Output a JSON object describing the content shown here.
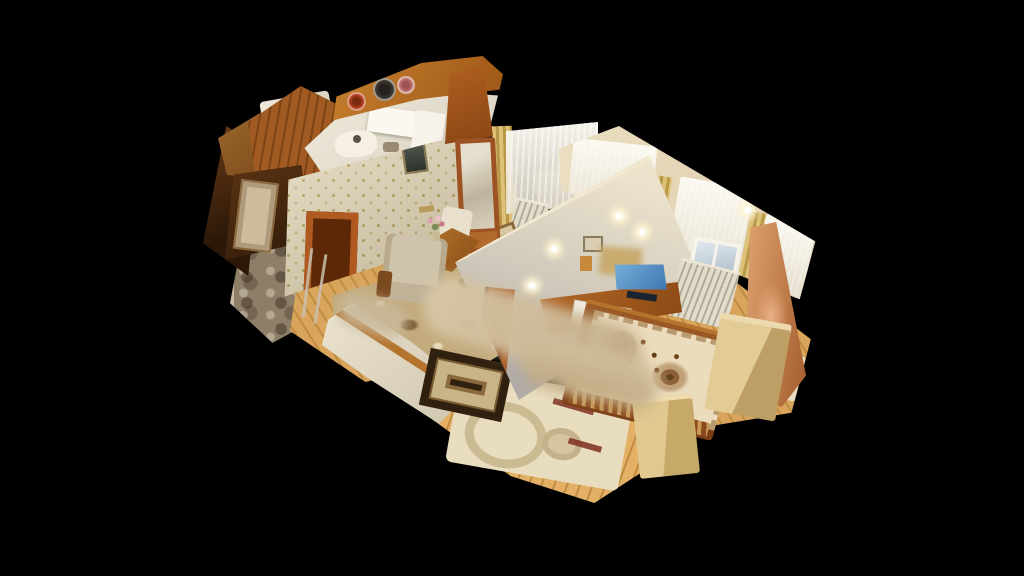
{
  "meta": {
    "type": "3d-dollhouse-scan-view",
    "description": "Cutaway dollhouse view of a furnished apartment 3D scan floating on a black background; no UI chrome, no text",
    "width": 1024,
    "height": 576
  },
  "viewport": {
    "background": "#000000",
    "interaction": "drag-to-orbit-model"
  },
  "rooms": [
    {
      "name": "kitchen",
      "position": "top",
      "features": [
        "white-counters",
        "fridge",
        "wood-upper-wall",
        "three-decorative-wall-plates"
      ]
    },
    {
      "name": "bathroom",
      "position": "top-left",
      "features": [
        "wood-panel-walls",
        "picture-frames",
        "white-fixture"
      ]
    },
    {
      "name": "hallway",
      "position": "left",
      "features": [
        "dark-wood-paneling",
        "beige-door",
        "mottled-carpet-floor",
        "thin-rails"
      ]
    },
    {
      "name": "living-room",
      "position": "center",
      "features": [
        "beige-diamond-wallpaper-wall",
        "dark-wall-vent",
        "wood-doorway",
        "mirror-dresser",
        "armchair",
        "high-back-chair",
        "wood-table-with-pink-flowers",
        "ornate-medallion-carpet",
        "oak-floor"
      ]
    },
    {
      "name": "back-room",
      "position": "center-right-behind-wall",
      "features": [
        "large-lace-window",
        "yellow-drapes",
        "radiator",
        "carpet-glimpse"
      ]
    },
    {
      "name": "bedroom",
      "position": "right",
      "features": [
        "cream-plank-divider-wall-with-spotlights",
        "lace-curtained-window",
        "red-windowsill-flowers",
        "radiator",
        "tv-with-blue-screen",
        "wood-tv-stand",
        "bed-with-floral-tapestry",
        "black-scan-hole",
        "tan-cabinet",
        "nightstand",
        "oak-plank-floor",
        "cream-rug-with-rings"
      ]
    }
  ],
  "scan_artifacts": [
    "privacy-blur-streaks-center",
    "missing-geometry-black-hole",
    "ragged-cut-wall-edges"
  ],
  "palette": {
    "bg": "#000000",
    "kitchenWood": "#c8802e",
    "kitchenWhite": "#f2ecdf",
    "plateRed": "#7a2a10",
    "plateDark": "#46403c",
    "platePink": "#cc8484",
    "bathWood": "#9c6a2e",
    "hallWood": "#a05a22",
    "doorBeige": "#cdbb9e",
    "hallFloorA": "#8d7e68",
    "wallpaper": "#dcd2b6",
    "doorFrameWood": "#99421a",
    "mirrorWood": "#9c5222",
    "tableWood": "#b5742e",
    "chair": "#cfc3ab",
    "drapeYellow": "#dcc176",
    "dividerWall": "#ece3cd",
    "extWall": "#ecdfc2",
    "windowFrame": "#f6f3ea",
    "windowGlass": "#dfe8ef",
    "radiator": "#e2dccb",
    "cutOrange": "#a45c2e",
    "cutPink": "#e0a470",
    "tvStand": "#b4682a",
    "tvScreen": "#3a72ae",
    "bedWood": "#9c5a26",
    "tapestry": "#eadcbc",
    "oak": "#d9a55c",
    "oakDark": "#c08c42",
    "oakBright": "#e3b066",
    "rugCream": "#e9ddc0",
    "rugRing": "#cbbb92",
    "carpetBase": "#c2aa7c",
    "smallRugBorder": "#30200f",
    "boxTan": "#e3cb96",
    "blurBeige": "#d9c8a8",
    "edgeLight": "#f2e7cf"
  }
}
